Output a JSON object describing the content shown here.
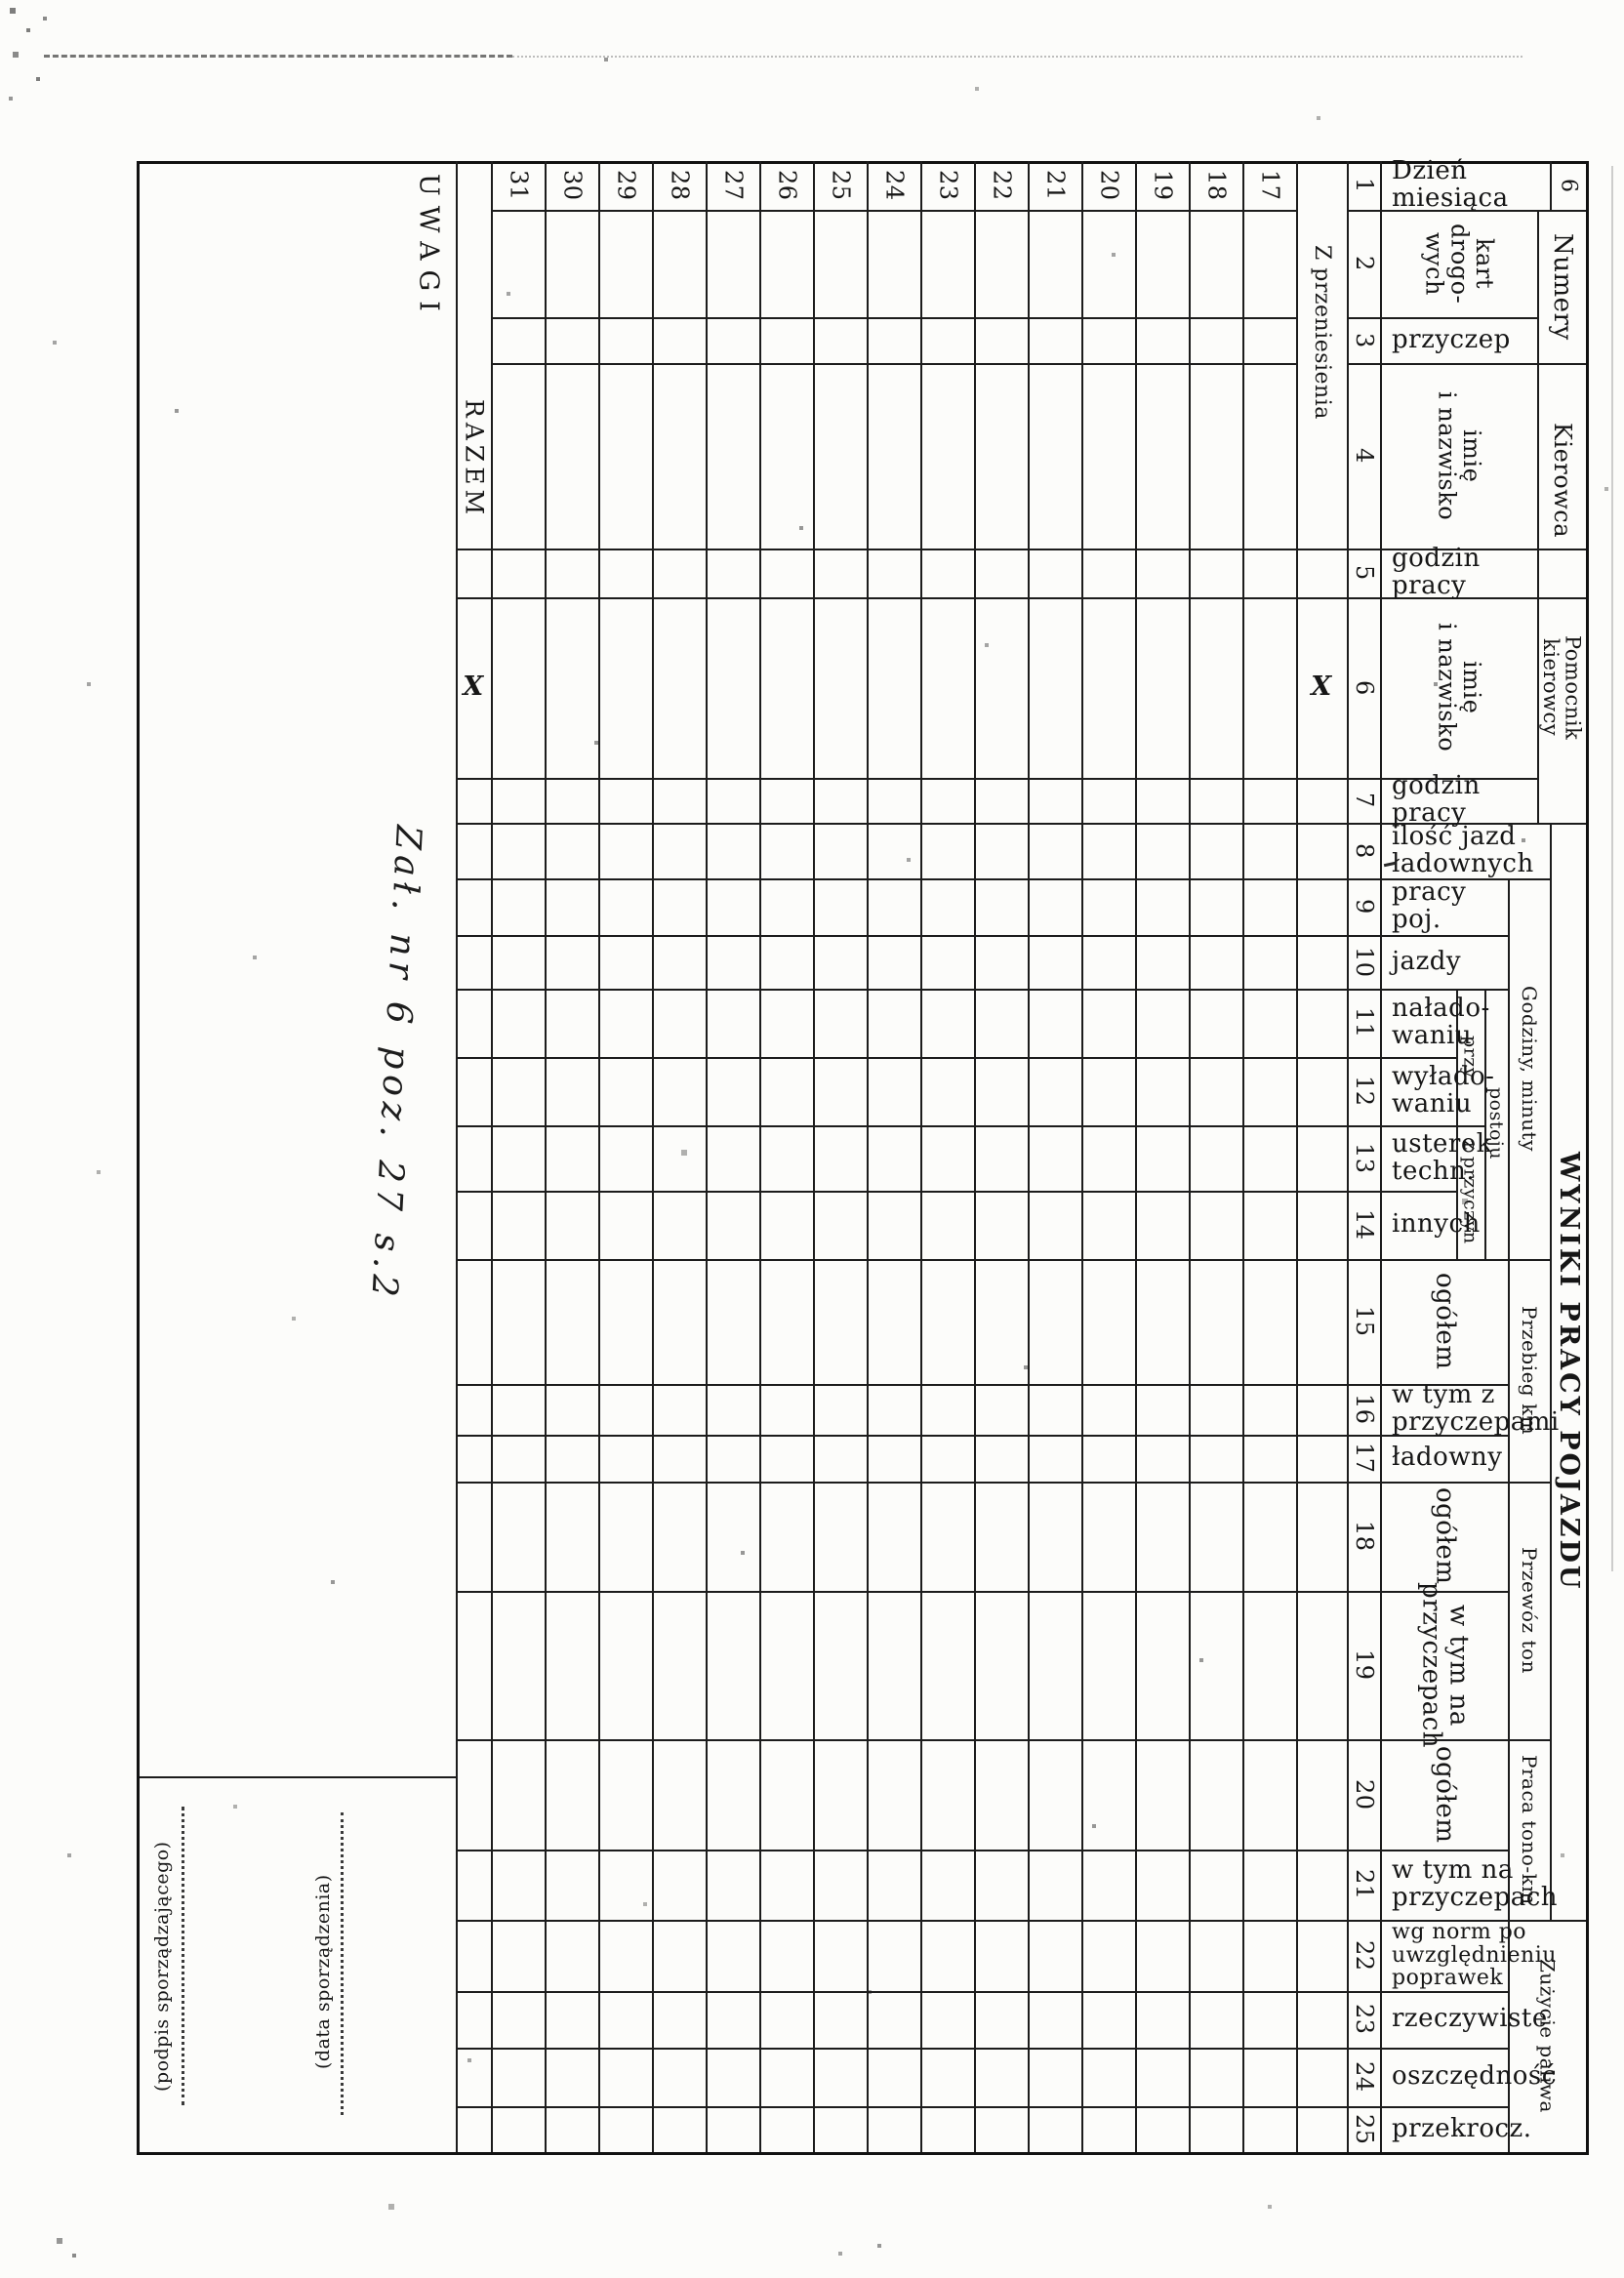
{
  "page": {
    "number": "6"
  },
  "note": {
    "handwritten": "Zał. nr 6 poz. 27 s.2"
  },
  "left": {
    "uwagi": "UWAGI",
    "razem": "RAZEM",
    "z_przeniesienia": "Z przeniesienia",
    "x_razem": "X",
    "x_przeniesienia": "X"
  },
  "days": [
    "31",
    "30",
    "29",
    "28",
    "27",
    "26",
    "25",
    "24",
    "23",
    "22",
    "21",
    "20",
    "19",
    "18",
    "17"
  ],
  "rows": [
    {
      "no": "1",
      "label": "Dzień miesiąca"
    },
    {
      "no": "2",
      "label": "kart\ndrogo-\nwych"
    },
    {
      "no": "3",
      "label": "przyczep"
    },
    {
      "no": "4",
      "label": "imię\ni nazwisko"
    },
    {
      "no": "5",
      "label": "godzin pracy"
    },
    {
      "no": "6",
      "label": "imię\ni nazwisko"
    },
    {
      "no": "7",
      "label": "godzin pracy"
    },
    {
      "no": "8",
      "label": "ilość jazd\nładownych"
    },
    {
      "no": "9",
      "label": "pracy poj."
    },
    {
      "no": "10",
      "label": "jazdy"
    },
    {
      "no": "11",
      "label": "nałado-\nwaniu"
    },
    {
      "no": "12",
      "label": "wyłado-\nwaniu"
    },
    {
      "no": "13",
      "label": "usterek\ntechn."
    },
    {
      "no": "14",
      "label": "innych"
    },
    {
      "no": "15",
      "label": "ogółem"
    },
    {
      "no": "16",
      "label": "w tym z\nprzyczepami"
    },
    {
      "no": "17",
      "label": "ładowny"
    },
    {
      "no": "18",
      "label": "ogółem"
    },
    {
      "no": "19",
      "label": "w tym na\nprzyczepach"
    },
    {
      "no": "20",
      "label": "ogółem"
    },
    {
      "no": "21",
      "label": "w tym na\nprzyczepach"
    },
    {
      "no": "22",
      "label": "wg norm po\nuwzględnieniu\npoprawek"
    },
    {
      "no": "23",
      "label": "rzeczywiste"
    },
    {
      "no": "24",
      "label": "oszczędność"
    },
    {
      "no": "25",
      "label": "przekrocz."
    }
  ],
  "groups": {
    "numery": "Numery",
    "kierowca": "Kierowca",
    "pomocnik": "Pomocnik\nkierowcy",
    "godziny": "Godziny, minuty",
    "przy": "przy",
    "postoju": "postoju",
    "z_przyczyn": "z przyczyn",
    "przebieg": "Przebieg km",
    "przewoz": "Przewóz ton",
    "praca": "Praca tono-km",
    "wyniki": "WYNIKI PRACY POJAZDU",
    "zuzycie": "Zużycie paliwa"
  },
  "signature": {
    "podpis": "(podpis sporządzającego)",
    "data": "(data sporządzenia)"
  }
}
